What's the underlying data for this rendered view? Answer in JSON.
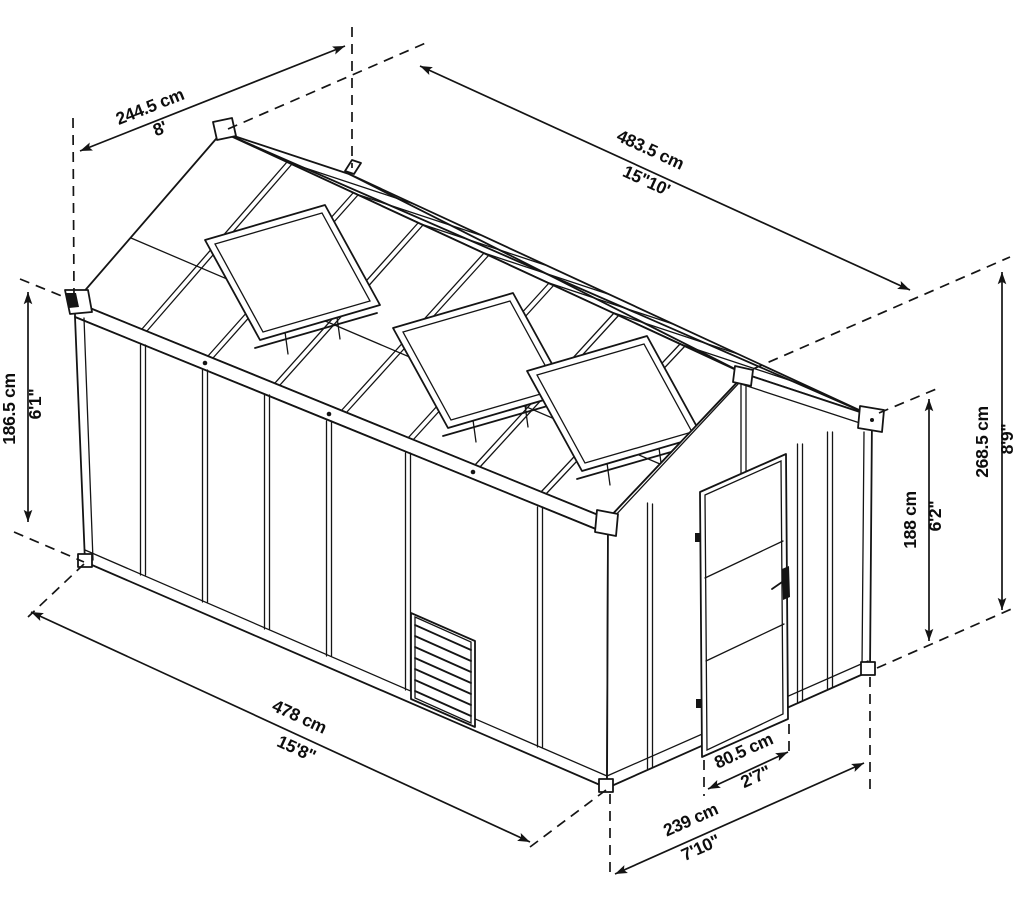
{
  "diagram": {
    "kind": "greenhouse-isometric-dimension-drawing",
    "dimensions": {
      "roof_width": {
        "metric": "244.5 cm",
        "imperial": "8'"
      },
      "total_length": {
        "metric": "483.5 cm",
        "imperial": "15\"10'"
      },
      "side_wall_height": {
        "metric": "186.5 cm",
        "imperial": "6'1\""
      },
      "total_height": {
        "metric": "268.5 cm",
        "imperial": "8'9\""
      },
      "door_height": {
        "metric": "188 cm",
        "imperial": "6'2\""
      },
      "side_length": {
        "metric": "478 cm",
        "imperial": "15'8\""
      },
      "door_width": {
        "metric": "80.5 cm",
        "imperial": "2'7\""
      },
      "gable_width": {
        "metric": "239 cm",
        "imperial": "7'10\""
      }
    }
  }
}
